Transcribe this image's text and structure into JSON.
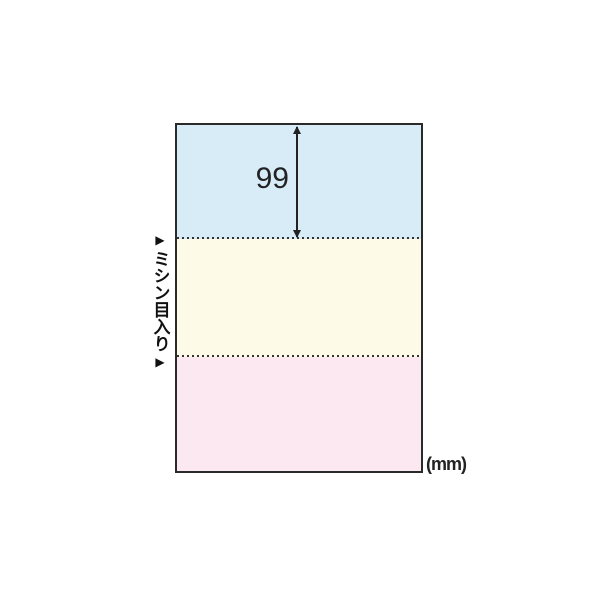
{
  "diagram": {
    "type": "product-dimension-diagram",
    "labels": {
      "dimension_value": "99",
      "unit": "(mm)",
      "perforation": "ミシン目入り"
    },
    "icons": {
      "marker_glyph": "▶"
    },
    "colors": {
      "background": "#ffffff",
      "paper_border": "#2a2a2a",
      "section_blue": "#d8ecf8",
      "section_cream": "#fdfbe8",
      "section_pink": "#fbe8f1",
      "line": "#222222",
      "text": "#111111"
    },
    "sections": [
      {
        "position": "top",
        "color_name": "blue"
      },
      {
        "position": "middle",
        "color_name": "cream"
      },
      {
        "position": "bottom",
        "color_name": "pink"
      }
    ]
  }
}
